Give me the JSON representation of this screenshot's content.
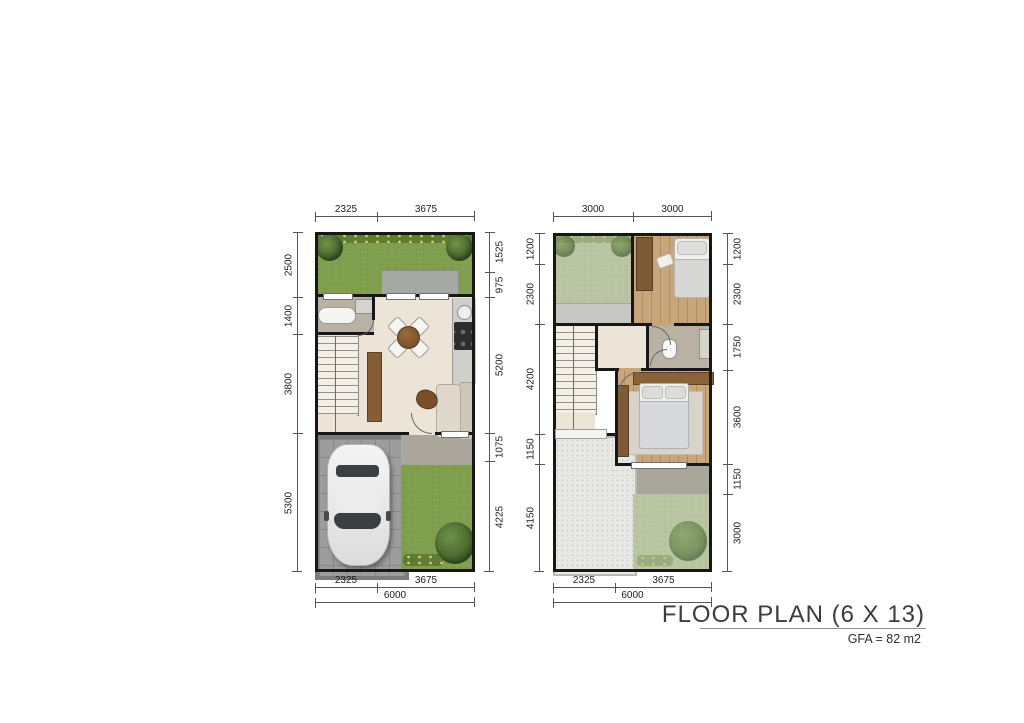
{
  "title_block": {
    "title": "FLOOR PLAN (6 X 13)",
    "gfa": "GFA = 82 m2"
  },
  "ground_floor": {
    "dims": {
      "top": [
        "2325",
        "3675"
      ],
      "left": [
        "2500",
        "1400",
        "3800",
        "5300"
      ],
      "right": [
        "1525",
        "975",
        "5200",
        "1075",
        "4225"
      ],
      "bottom": [
        "2325",
        "3675"
      ],
      "total": [
        "6000"
      ]
    }
  },
  "upper_floor": {
    "dims": {
      "top": [
        "3000",
        "3000"
      ],
      "left": [
        "1200",
        "2300",
        "4200",
        "1150",
        "4150"
      ],
      "right": [
        "1200",
        "2300",
        "1750",
        "3600",
        "1150",
        "3000"
      ],
      "bottom": [
        "2325",
        "3675"
      ],
      "total": [
        "6000"
      ]
    }
  },
  "palette": {
    "wall": "#171717",
    "lawn": "#80a050",
    "roof_lawn": "#b9c5a3",
    "interior_floor": "#ece5d7",
    "wood_floor": "#c7a67c",
    "terrace": "#aba69b",
    "garage_paver": "#9d9d9d",
    "roof_deck": "#e7e7e4",
    "dimension_text": "#1d1d1d"
  }
}
